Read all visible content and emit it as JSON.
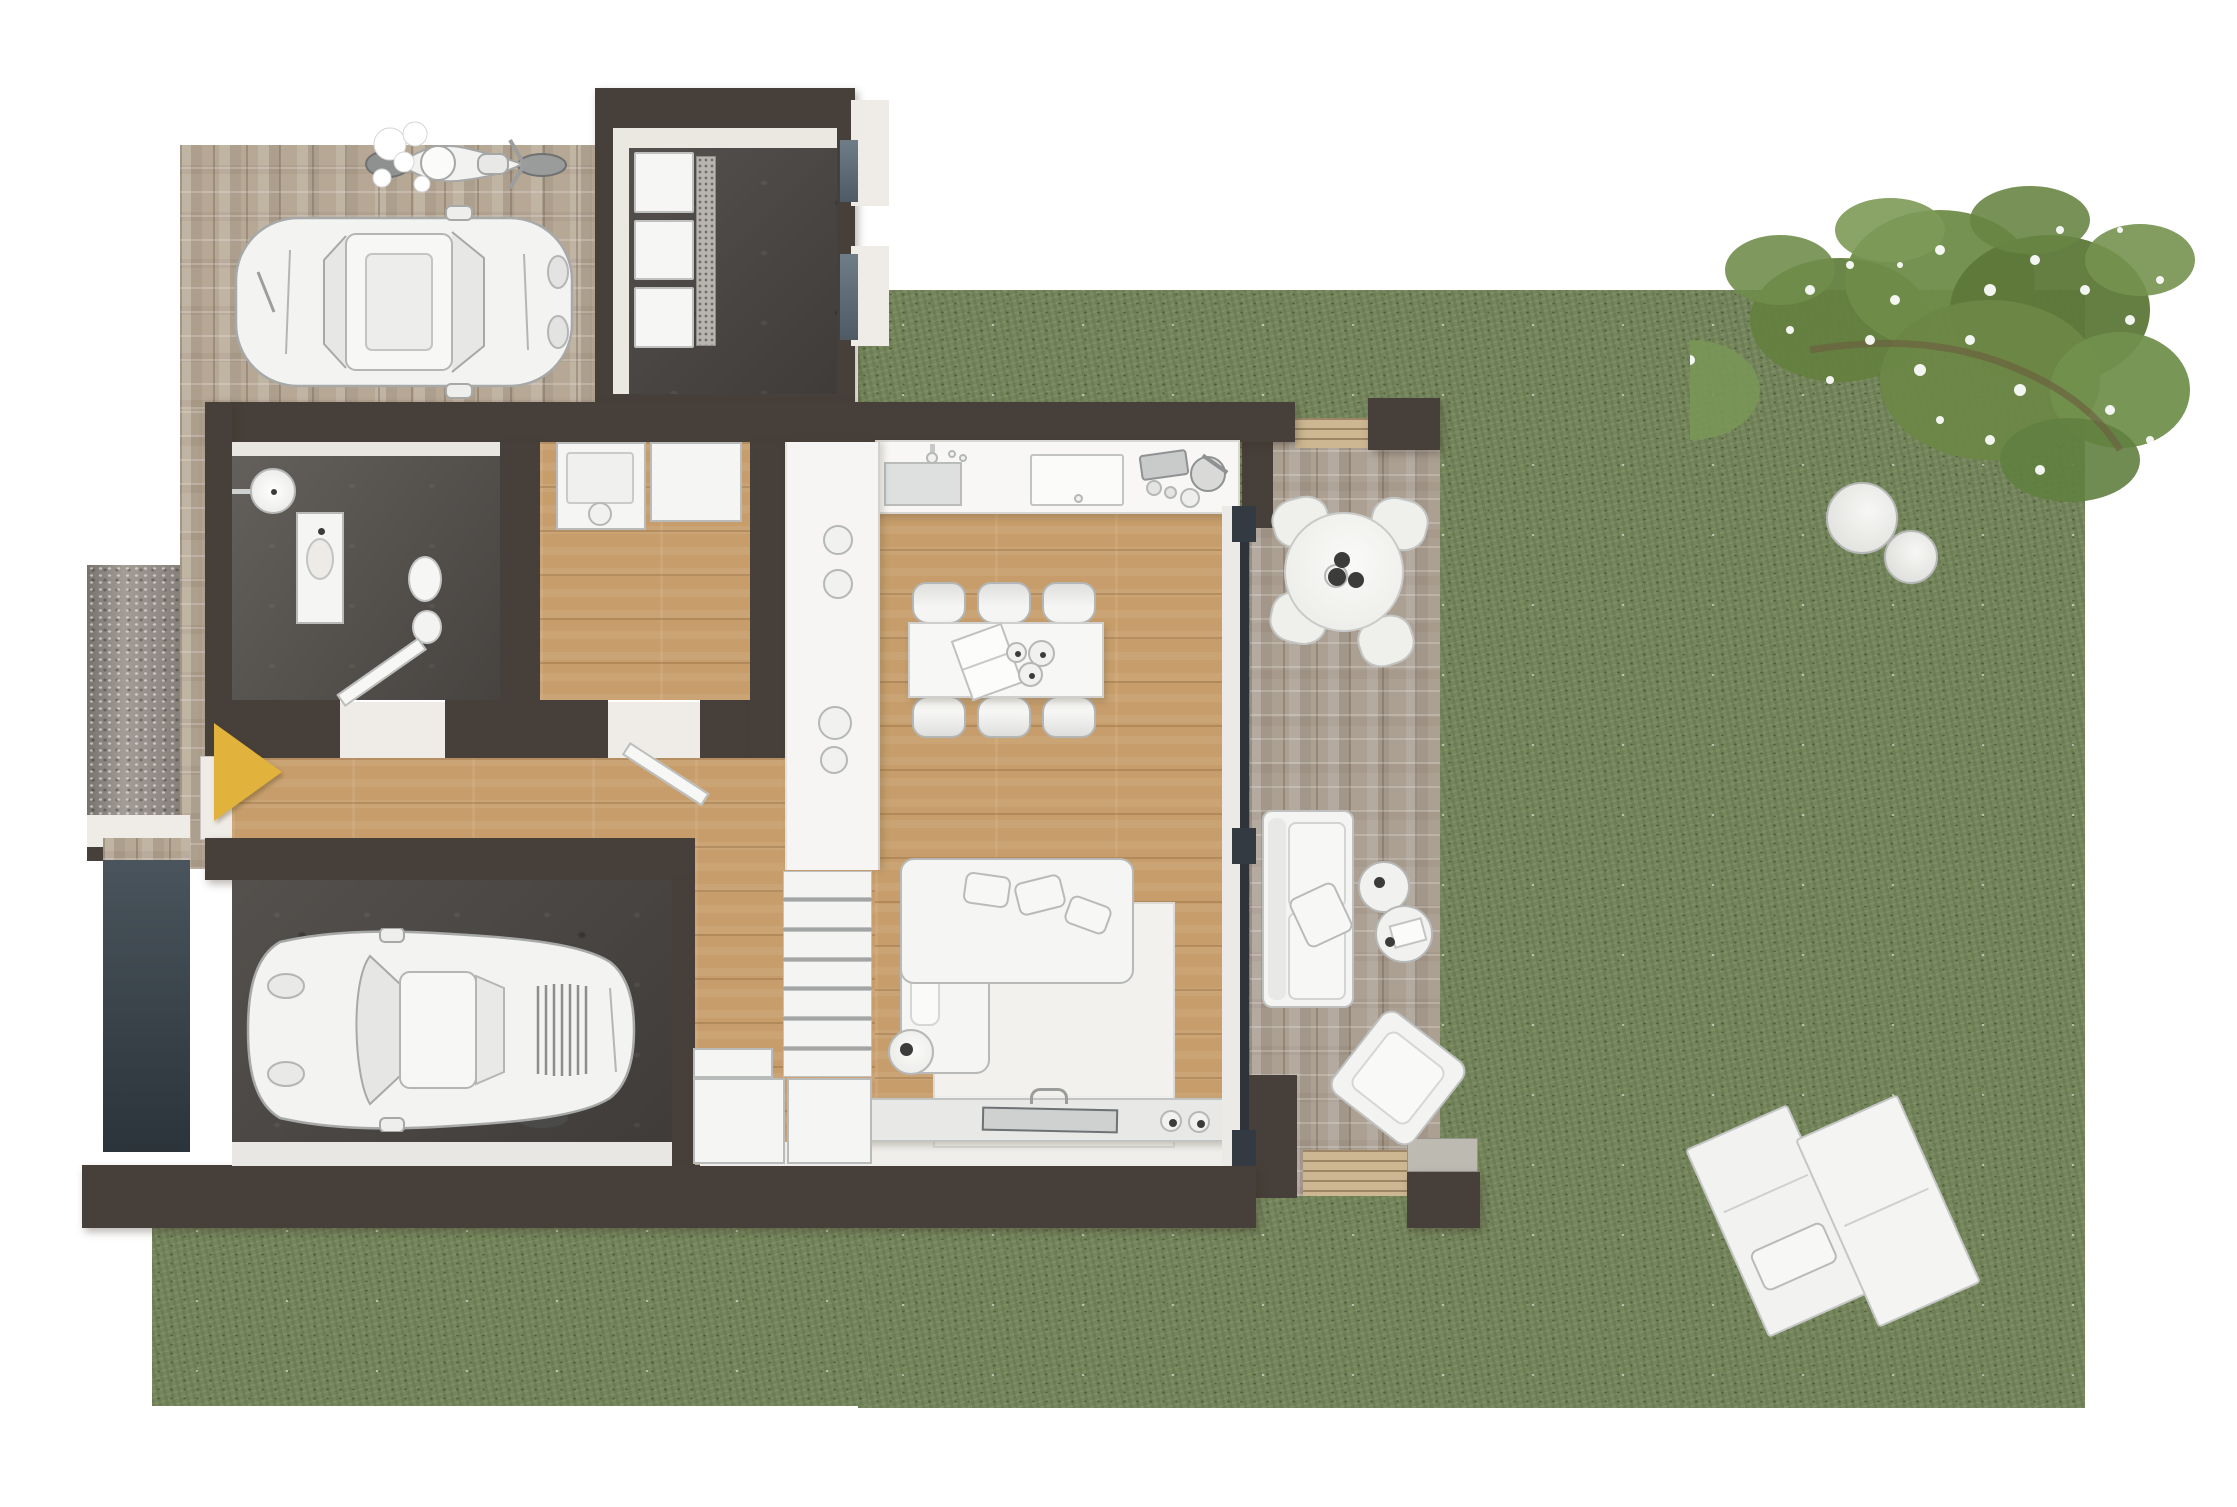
{
  "scene": {
    "type": "3d-floor-plan-top-down-render",
    "description": "Top-down 3D render of a modern single-storey house with garage, carport, storage room, stone patio and large lawn garden",
    "background_color": "#ffffff",
    "has_text": false
  },
  "palette": {
    "wall": "#473F39",
    "wood_floor": "#C79E6B",
    "concrete_dark": "#4B4744",
    "bathroom_tile": "#56524E",
    "grass": "#75865C",
    "pavers_beige": "#B9AB99",
    "pavers_gray": "#ACA195",
    "deck_wood": "#CDB792",
    "white_furniture": "#F5F5F3",
    "glass_slate": "#66737E",
    "arrow_yellow": "#E2B33C"
  },
  "entrance": {
    "marker_shape": "triangle pointing right",
    "marker_color": "#E2B33C"
  },
  "outdoor": {
    "lawn": {
      "name": "Lawn"
    },
    "flowering_tree": {
      "name": "Flowering shrub with white blossoms"
    },
    "stools": {
      "name": "Round garden stools",
      "count": 2
    },
    "sun_loungers": {
      "name": "Sun loungers",
      "count": 2,
      "pillows": 1
    },
    "carport": {
      "name": "Carport on stone pavers",
      "vehicles": [
        "white city car",
        "white motorcycle"
      ]
    },
    "walkway": {
      "name": "Paved entrance walkway"
    },
    "privacy_wall": {
      "name": "Stone privacy wall at entrance"
    },
    "garage_door": {
      "name": "Garage door panel"
    },
    "patio": {
      "name": "Stone patio",
      "round_table": {
        "name": "Round patio dining table",
        "seats": 4,
        "items_on_table": 3
      },
      "sofa": {
        "name": "Outdoor sofa",
        "pillows": 1
      },
      "side_tables": {
        "count": 2,
        "items": [
          "book",
          "cups"
        ]
      },
      "lounge_chair": {
        "name": "Outdoor lounge chair"
      },
      "decks": {
        "count": 2
      }
    }
  },
  "rooms": {
    "utility": {
      "name": "Storage room",
      "floor": "dark concrete",
      "storage_boxes": 3,
      "windows": 2
    },
    "bathroom": {
      "name": "Bathroom",
      "fixtures": [
        "walk-in shower",
        "vanity sink",
        "toilet"
      ],
      "door_open": true
    },
    "laundry": {
      "name": "Laundry room",
      "appliances": [
        "washing machine",
        "cabinet"
      ],
      "door_open": true
    },
    "hallway": {
      "name": "Entrance hallway"
    },
    "kitchen": {
      "name": "Kitchen",
      "fixtures": [
        "counter with sink and faucet",
        "cooktop",
        "cookware set",
        "tall cabinet column"
      ],
      "column_circles": 4
    },
    "dining": {
      "name": "Dining area",
      "chairs_top": 3,
      "chairs_bottom": 3,
      "items_on_table": [
        "open book",
        "three bowls"
      ]
    },
    "living": {
      "name": "Living area",
      "furniture": [
        "L-shaped sofa",
        "white rug",
        "round side table",
        "TV sideboard",
        "flat TV",
        "two speakers"
      ],
      "sofa_pillows": 3,
      "speakers": 2
    },
    "stairs": {
      "name": "Staircase",
      "treads": 7,
      "storage_blocks": 3
    },
    "garage": {
      "name": "Garage",
      "floor": "dark concrete",
      "vehicle": "white sports car"
    }
  }
}
